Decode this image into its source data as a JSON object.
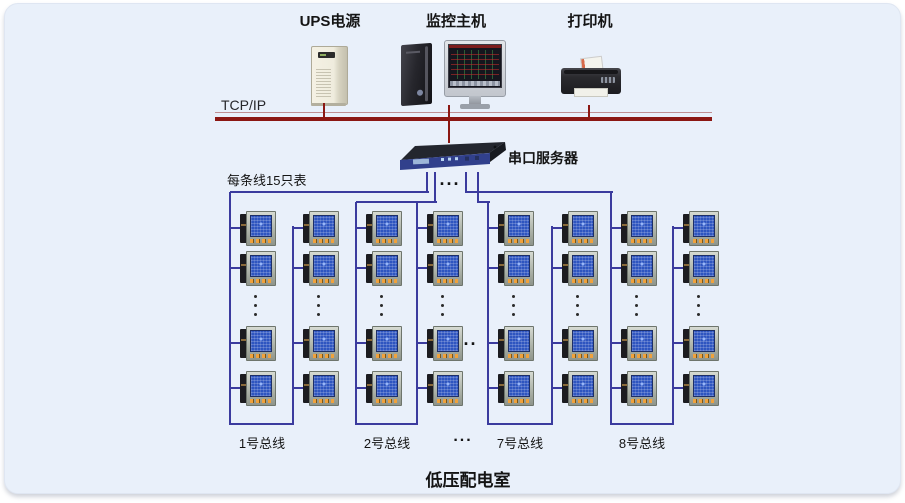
{
  "top_devices": [
    {
      "name": "ups",
      "label": "UPS电源"
    },
    {
      "name": "monitor-host",
      "label": "监控主机"
    },
    {
      "name": "printer",
      "label": "打印机"
    }
  ],
  "network": {
    "bus_label": "TCP/IP"
  },
  "serial_server": {
    "label": "串口服务器"
  },
  "annotations": {
    "meters_per_line": "每条线15只表",
    "ellipsis": "..."
  },
  "buses": [
    {
      "label": "1号总线"
    },
    {
      "label": "2号总线"
    },
    {
      "label": "7号总线"
    },
    {
      "label": "8号总线"
    }
  ],
  "meter_grid": {
    "visible_rows": 4,
    "visible_columns": 8
  },
  "room_label": "低压配电室",
  "colors": {
    "panel_bg": "#e9f0fa",
    "line_blue": "#3b3b9e",
    "line_red": "#8b1712"
  }
}
